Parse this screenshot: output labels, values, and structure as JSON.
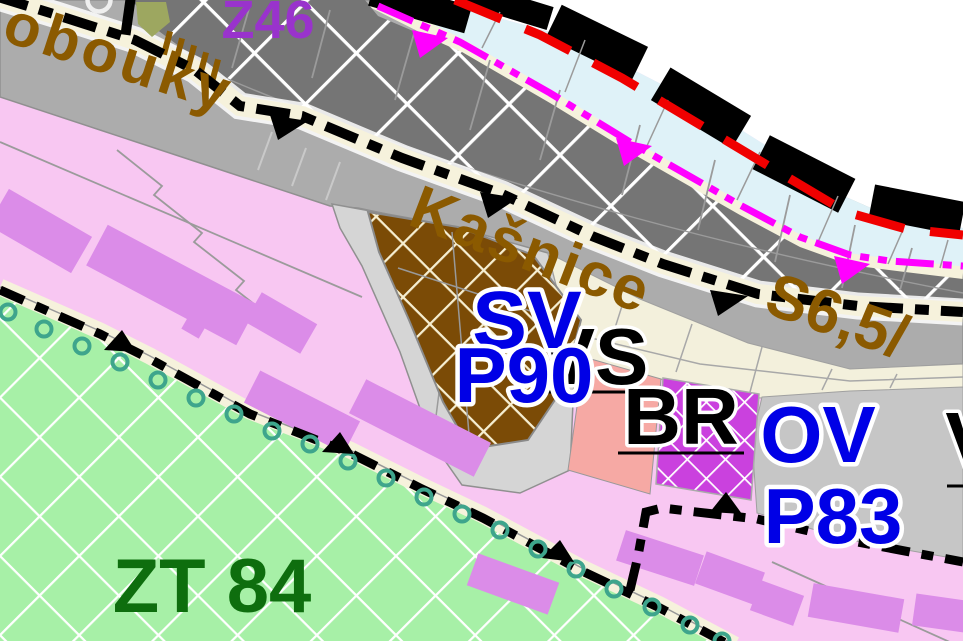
{
  "map": {
    "kind": "municipal zoning plan (územní plán) detail",
    "labels": {
      "zone_change_top": "Z46",
      "street_left": "obouky",
      "street_center": "Kašnice",
      "road_class": "S6,5/",
      "zone_sv": "SV",
      "zone_sv_code": "P90",
      "zone_vs": "VS",
      "zone_br": "BR",
      "zone_ov": "OV",
      "zone_ov_code": "P83",
      "zone_v": "V",
      "zone_zt": "ZT 84"
    },
    "colors": {
      "purple_label": "#9933CC",
      "street_label_brown": "#8B5A00",
      "change_label_blue": "#0000E6",
      "zone_label_black": "#000000",
      "zt_label_green": "#0E6E0E",
      "pink_residential": "#F8C7F2",
      "violet_building": "#DB8CE8",
      "green_zt_zone": "#A7F0A7",
      "dark_gray_zone": "#757575",
      "road_gray": "#ACACAC",
      "light_gray_zone": "#D5D5D5",
      "beige_zone": "#F3F0DC",
      "gray_v_zone": "#C6C6C6",
      "blue_water_strip": "#DFF2F8",
      "cream_strip": "#F6F2DC",
      "brown_sv_zone": "#7B4B06",
      "salmon_block": "#F6A9A4",
      "magenta_ov_zone": "#CA41DE",
      "boundary_black": "#000000",
      "red_dashed_line": "#F00000",
      "magenta_route_line": "#FF00FF",
      "teal_boundary_circles": "#3EA58C",
      "olive_patch": "#9DA760",
      "outside_white": "#FFFFFF"
    }
  }
}
